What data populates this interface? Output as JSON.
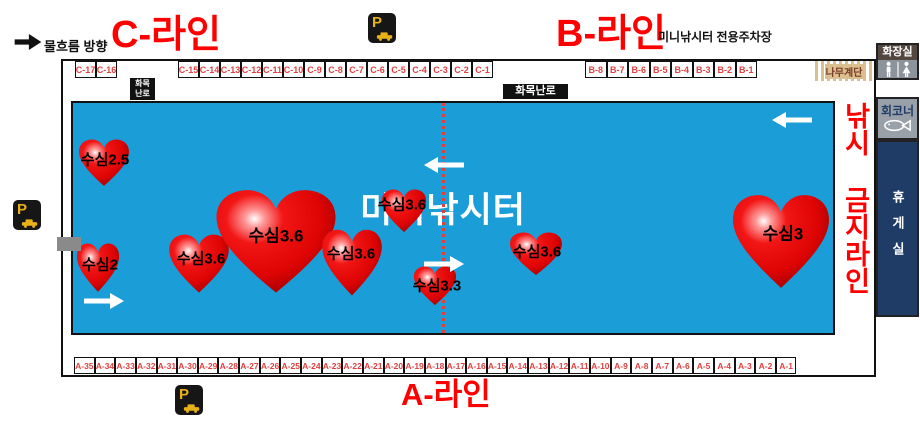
{
  "header": {
    "flow_label": "물흐름 방향",
    "c_line_title": "C-라인",
    "b_line_title": "B-라인",
    "parking_note": "미니낚시터 전용주차장"
  },
  "footer": {
    "a_line_title": "A-라인"
  },
  "pond": {
    "name": "미니낚시터",
    "no_fishing_label": "낚시 금지라인",
    "hearts": [
      {
        "label": "수심2.5",
        "x": 31,
        "y": 60,
        "w": 52,
        "h": 48,
        "lx": 32,
        "ly": 57
      },
      {
        "label": "수심2",
        "x": 25,
        "y": 165,
        "w": 44,
        "h": 50,
        "lx": 27,
        "ly": 162
      },
      {
        "label": "수심3.6",
        "x": 126,
        "y": 161,
        "w": 62,
        "h": 60,
        "lx": 128,
        "ly": 156
      },
      {
        "label": "수심3.6",
        "x": 203,
        "y": 139,
        "w": 124,
        "h": 106,
        "lx": 203,
        "ly": 133
      },
      {
        "label": "수심3.6",
        "x": 279,
        "y": 160,
        "w": 62,
        "h": 68,
        "lx": 278,
        "ly": 151
      },
      {
        "label": "수심3.6",
        "x": 331,
        "y": 108,
        "w": 46,
        "h": 44,
        "lx": 329,
        "ly": 102
      },
      {
        "label": "수심3.3",
        "x": 362,
        "y": 183,
        "w": 44,
        "h": 40,
        "lx": 364,
        "ly": 183
      },
      {
        "label": "수심3.6",
        "x": 463,
        "y": 151,
        "w": 54,
        "h": 44,
        "lx": 464,
        "ly": 149
      },
      {
        "label": "수심3",
        "x": 708,
        "y": 139,
        "w": 100,
        "h": 96,
        "lx": 710,
        "ly": 131
      }
    ],
    "arrows": [
      {
        "dir": "right",
        "x": 31,
        "y": 198
      },
      {
        "dir": "left",
        "x": 371,
        "y": 62
      },
      {
        "dir": "right",
        "x": 371,
        "y": 161
      },
      {
        "dir": "left",
        "x": 719,
        "y": 17
      }
    ]
  },
  "stalls": {
    "c_row_left": [
      "C-17",
      "C-16"
    ],
    "c_row_right": [
      "C-15",
      "C-14",
      "C-13",
      "C-12",
      "C-11",
      "C-10",
      "C-9",
      "C-8",
      "C-7",
      "C-6",
      "C-5",
      "C-4",
      "C-3",
      "C-2",
      "C-1"
    ],
    "b_row": [
      "B-8",
      "B-7",
      "B-6",
      "B-5",
      "B-4",
      "B-3",
      "B-2",
      "B-1"
    ],
    "a_row": [
      "A-35",
      "A-34",
      "A-33",
      "A-32",
      "A-31",
      "A-30",
      "A-29",
      "A-28",
      "A-27",
      "A-26",
      "A-25",
      "A-24",
      "A-23",
      "A-22",
      "A-21",
      "A-20",
      "A-19",
      "A-18",
      "A-17",
      "A-16",
      "A-15",
      "A-14",
      "A-13",
      "A-12",
      "A-11",
      "A-10",
      "A-9",
      "A-8",
      "A-7",
      "A-6",
      "A-5",
      "A-4",
      "A-3",
      "A-2",
      "A-1"
    ]
  },
  "facilities": {
    "stove_line1": "화목",
    "stove_line2": "난로",
    "stove_horizontal": "화목난로",
    "wooden_stairs": "나무계단",
    "toilet": "화장실",
    "raw_fish_corner": "회코너",
    "rest_room": "휴게실"
  },
  "icons": {
    "parking_letter": "P"
  },
  "colors": {
    "pond_blue": "#1b9ed8",
    "heart_red": "#e60000",
    "title_red": "#ff0000",
    "stall_text_red": "#e04040",
    "rest_room_navy": "#1f3c66",
    "stairs_tan": "#d9c08e",
    "parking_gold": "#e8b019",
    "toilet_header_brown": "#54473f",
    "facility_gray": "#8d939b"
  }
}
